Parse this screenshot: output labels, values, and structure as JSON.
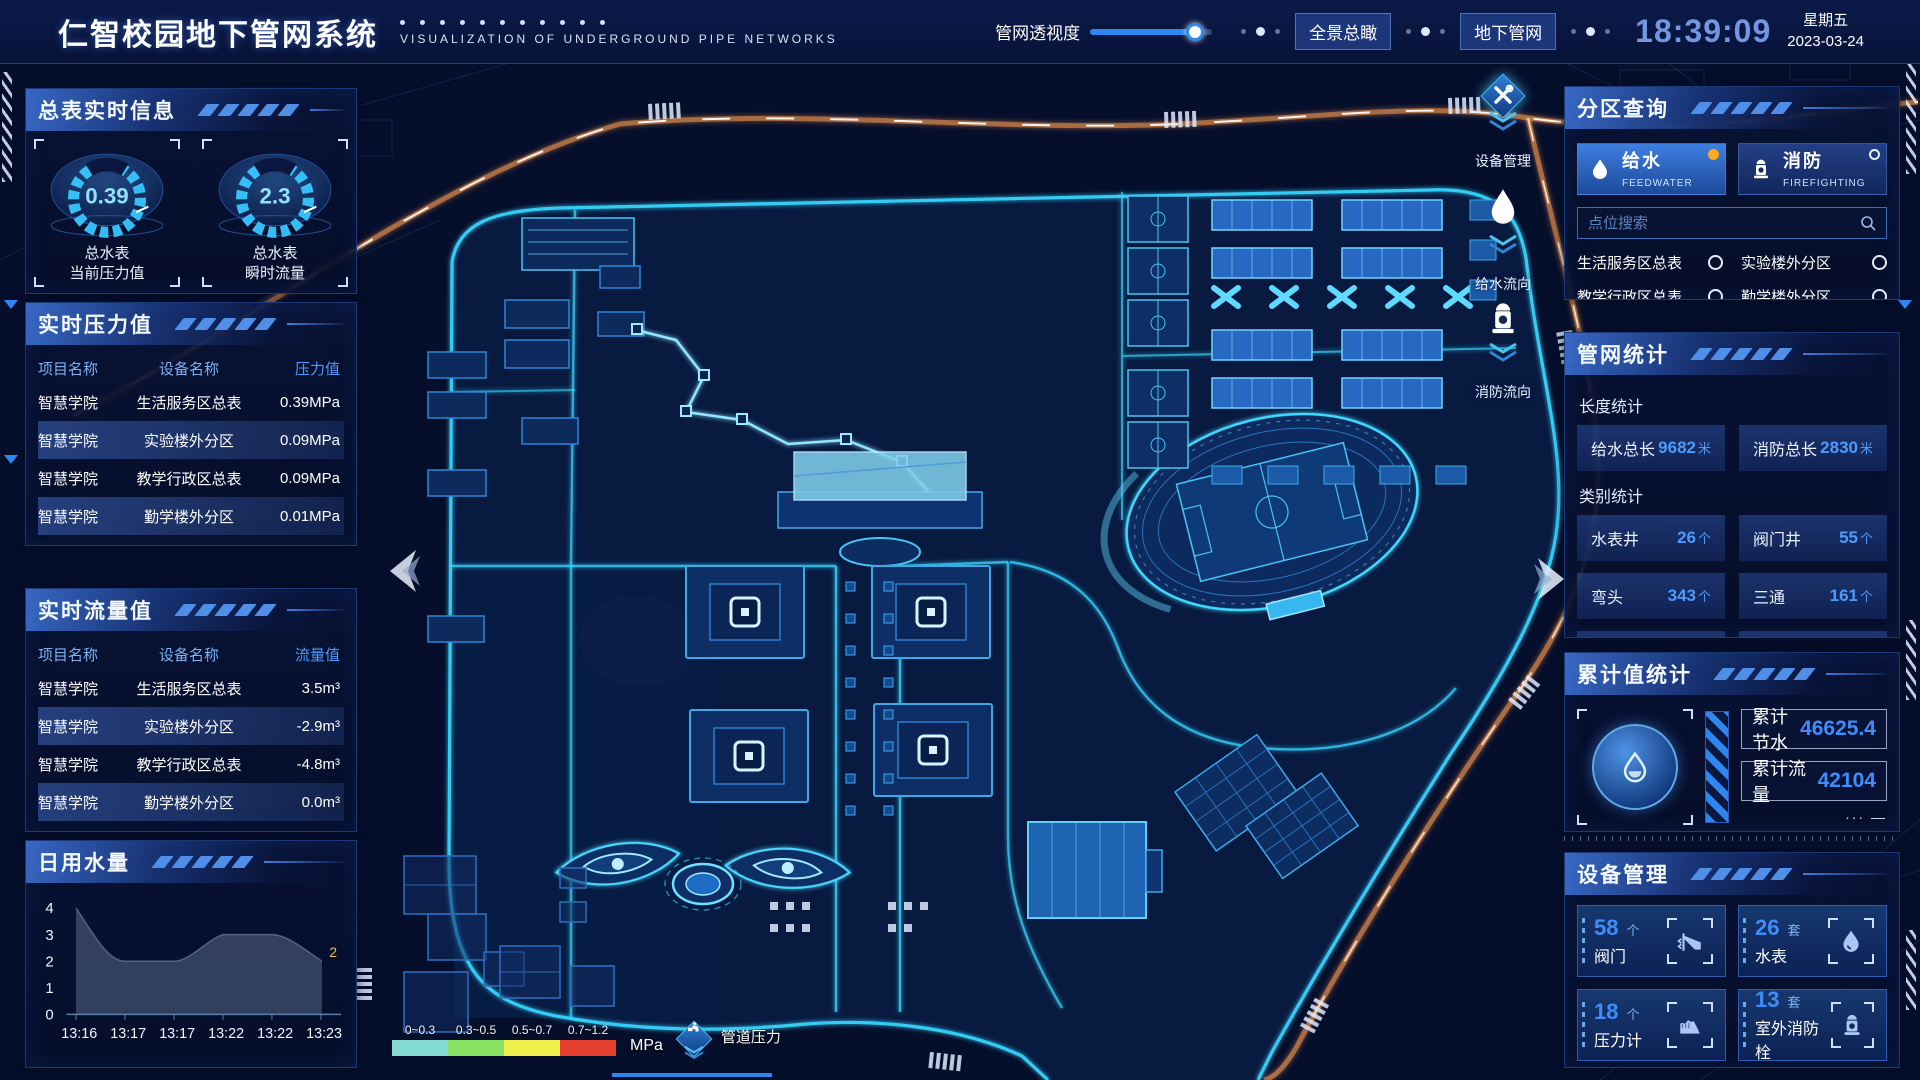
{
  "header": {
    "title": "仁智校园地下管网系统",
    "subtitle": "VISUALIZATION OF UNDERGROUND PIPE NETWORKS",
    "slider_label": "管网透视度",
    "btn_overview": "全景总瞰",
    "btn_underground": "地下管网",
    "clock": "18:39:09",
    "weekday": "星期五",
    "date": "2023-03-24"
  },
  "left": {
    "summary": {
      "title": "总表实时信息",
      "gauges": [
        {
          "value": "0.39",
          "line1": "总水表",
          "line2": "当前压力值"
        },
        {
          "value": "2.3",
          "line1": "总水表",
          "line2": "瞬时流量"
        }
      ]
    },
    "pressure": {
      "title": "实时压力值",
      "headers": {
        "project": "项目名称",
        "device": "设备名称",
        "value": "压力值"
      },
      "rows": [
        {
          "project": "智慧学院",
          "device": "生活服务区总表",
          "value": "0.39MPa"
        },
        {
          "project": "智慧学院",
          "device": "实验楼外分区",
          "value": "0.09MPa"
        },
        {
          "project": "智慧学院",
          "device": "教学行政区总表",
          "value": "0.09MPa"
        },
        {
          "project": "智慧学院",
          "device": "勤学楼外分区",
          "value": "0.01MPa"
        },
        {
          "project": "智慧学院",
          "device": "砺学楼外分区",
          "value": "0.00MPa"
        }
      ]
    },
    "flow": {
      "title": "实时流量值",
      "headers": {
        "project": "项目名称",
        "device": "设备名称",
        "value": "流量值"
      },
      "rows": [
        {
          "project": "智慧学院",
          "device": "生活服务区总表",
          "value": "3.5m³"
        },
        {
          "project": "智慧学院",
          "device": "实验楼外分区",
          "value": "-2.9m³"
        },
        {
          "project": "智慧学院",
          "device": "教学行政区总表",
          "value": "-4.8m³"
        },
        {
          "project": "智慧学院",
          "device": "勤学楼外分区",
          "value": "0.0m³"
        },
        {
          "project": "智慧学院",
          "device": "砺学楼外分区",
          "value": "2.3m³"
        }
      ]
    },
    "daily": {
      "title": "日用水量"
    }
  },
  "right": {
    "zone": {
      "title": "分区查询",
      "feedwater": {
        "label": "给水",
        "sub": "FEEDWATER"
      },
      "firefighting": {
        "label": "消防",
        "sub": "FIREFIGHTING"
      },
      "search_placeholder": "点位搜索",
      "items": [
        {
          "label": "生活服务区总表"
        },
        {
          "label": "实验楼外分区"
        },
        {
          "label": "教学行政区总表"
        },
        {
          "label": "勤学楼外分区"
        },
        {
          "label": "砺学楼外分区"
        },
        {
          "label": "宿舍区泵房"
        }
      ]
    },
    "stats": {
      "title": "管网统计",
      "length_title": "长度统计",
      "length_items": [
        {
          "label": "给水总长",
          "value": "9682",
          "unit": "米"
        },
        {
          "label": "消防总长",
          "value": "2830",
          "unit": "米"
        }
      ],
      "category_title": "类别统计",
      "category_items": [
        {
          "label": "水表井",
          "value": "26",
          "unit": "个"
        },
        {
          "label": "阀门井",
          "value": "55",
          "unit": "个"
        },
        {
          "label": "弯头",
          "value": "343",
          "unit": "个"
        },
        {
          "label": "三通",
          "value": "161",
          "unit": "个"
        }
      ]
    },
    "cumulative": {
      "title": "累计值统计",
      "rows": [
        {
          "label": "累计节水",
          "value": "46625.4"
        },
        {
          "label": "累计流量",
          "value": "42104"
        }
      ]
    },
    "devices": {
      "title": "设备管理",
      "cards": [
        {
          "count": "58",
          "unit": "个",
          "label": "阀门",
          "icon": "valve-icon"
        },
        {
          "count": "26",
          "unit": "套",
          "label": "水表",
          "icon": "water-meter-icon"
        },
        {
          "count": "18",
          "unit": "个",
          "label": "压力计",
          "icon": "pressure-gauge-icon"
        },
        {
          "count": "13",
          "unit": "套",
          "label": "室外消防栓",
          "icon": "hydrant-icon"
        }
      ]
    }
  },
  "map_tools": [
    {
      "label": "设备管理",
      "icon": "tools-icon"
    },
    {
      "label": "给水流向",
      "icon": "water-drop-icon"
    },
    {
      "label": "消防流向",
      "icon": "hydrant-icon"
    }
  ],
  "legend": {
    "ranges": [
      {
        "label": "0~0.3",
        "color": "#86dcd2"
      },
      {
        "label": "0.3~0.5",
        "color": "#8ae263"
      },
      {
        "label": "0.5~0.7",
        "color": "#f2ee4e"
      },
      {
        "label": "0.7~1.2",
        "color": "#e6402e"
      }
    ],
    "unit": "MPa",
    "pressure_label": "管道压力"
  },
  "chart_data": {
    "type": "area",
    "title": "日用水量",
    "x": [
      "13:16",
      "13:17",
      "13:17",
      "13:22",
      "13:22",
      "13:23"
    ],
    "values": [
      4,
      2,
      2,
      3,
      3,
      2
    ],
    "yticks": [
      "4",
      "3",
      "2",
      "1",
      "0"
    ],
    "ylim": [
      0,
      4
    ],
    "end_label": "2",
    "fill_color": "#55688a",
    "grid": false,
    "legend_position": "none"
  },
  "colors": {
    "accent": "#35c1ff",
    "value_blue": "#4d9bff",
    "selected_radio": "#ffa826"
  }
}
